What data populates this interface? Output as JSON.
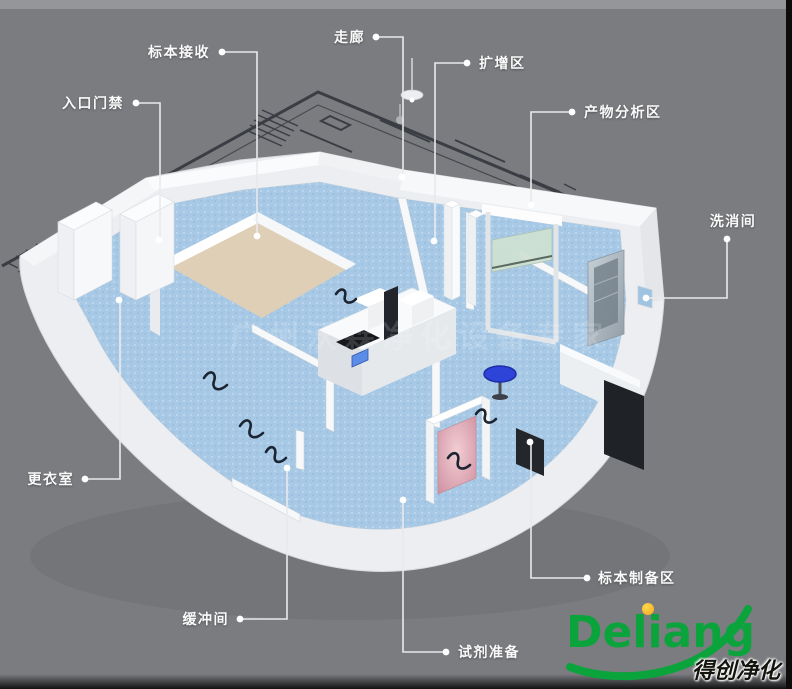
{
  "watermark": "广州沃霖净化设备专家",
  "labels": [
    {
      "id": "specimen-receiving",
      "text": "标本接收",
      "align": "right",
      "tx": 216,
      "ty": 52,
      "line": [
        [
          222,
          52
        ],
        [
          257,
          52
        ],
        [
          257,
          236
        ]
      ],
      "dots": [
        [
          222,
          52
        ],
        [
          257,
          236
        ]
      ]
    },
    {
      "id": "entrance-access",
      "text": "入口门禁",
      "align": "right",
      "tx": 130,
      "ty": 103,
      "line": [
        [
          136,
          103
        ],
        [
          160,
          103
        ],
        [
          160,
          240
        ]
      ],
      "dots": [
        [
          136,
          103
        ],
        [
          159,
          240
        ]
      ]
    },
    {
      "id": "corridor",
      "text": "走廊",
      "align": "right",
      "tx": 371,
      "ty": 37,
      "line": [
        [
          376,
          37
        ],
        [
          403,
          37
        ],
        [
          403,
          177
        ]
      ],
      "dots": [
        [
          376,
          37
        ],
        [
          402,
          177
        ]
      ]
    },
    {
      "id": "amplification-area",
      "text": "扩增区",
      "align": "left",
      "tx": 473,
      "ty": 63,
      "line": [
        [
          467,
          63
        ],
        [
          435,
          63
        ],
        [
          435,
          241
        ]
      ],
      "dots": [
        [
          467,
          63
        ],
        [
          434,
          241
        ]
      ]
    },
    {
      "id": "product-analysis-area",
      "text": "产物分析区",
      "align": "left",
      "tx": 578,
      "ty": 112,
      "line": [
        [
          572,
          112
        ],
        [
          531,
          112
        ],
        [
          531,
          205
        ]
      ],
      "dots": [
        [
          572,
          112
        ],
        [
          531,
          205
        ]
      ]
    },
    {
      "id": "washing-room",
      "text": "洗消间",
      "align": "center",
      "tx": 733,
      "ty": 221,
      "line": [
        [
          727,
          239
        ],
        [
          727,
          298
        ],
        [
          646,
          298
        ]
      ],
      "dots": [
        [
          727,
          239
        ],
        [
          646,
          298
        ]
      ]
    },
    {
      "id": "changing-room",
      "text": "更衣室",
      "align": "right",
      "tx": 80,
      "ty": 479,
      "line": [
        [
          85,
          479
        ],
        [
          120,
          479
        ],
        [
          120,
          300
        ]
      ],
      "dots": [
        [
          85,
          479
        ],
        [
          119,
          300
        ]
      ]
    },
    {
      "id": "buffer-room",
      "text": "缓冲间",
      "align": "right",
      "tx": 235,
      "ty": 619,
      "line": [
        [
          240,
          619
        ],
        [
          287,
          619
        ],
        [
          287,
          468
        ]
      ],
      "dots": [
        [
          240,
          619
        ],
        [
          287,
          468
        ]
      ]
    },
    {
      "id": "reagent-prep",
      "text": "试剂准备",
      "align": "left",
      "tx": 452,
      "ty": 652,
      "line": [
        [
          446,
          652
        ],
        [
          403,
          652
        ],
        [
          403,
          500
        ]
      ],
      "dots": [
        [
          446,
          652
        ],
        [
          403,
          500
        ]
      ]
    },
    {
      "id": "specimen-prep-area",
      "text": "标本制备区",
      "align": "left",
      "tx": 592,
      "ty": 578,
      "line": [
        [
          587,
          578
        ],
        [
          531,
          578
        ],
        [
          531,
          442
        ]
      ],
      "dots": [
        [
          587,
          578
        ],
        [
          530,
          442
        ]
      ]
    }
  ],
  "logo": {
    "brand": "Deliang",
    "tagline": "得创净化"
  },
  "colors": {
    "background": "#7b7c80",
    "floor-blue": "#a7c9e6",
    "floor-beige": "#decfb6",
    "wall-white": "#eceef1",
    "label-white": "#fafafa",
    "leader-line": "#e9eaec",
    "logo-green": "#0ba43c",
    "logo-orange": "#f3a81c",
    "cabinet-pink": "#dfa9b4",
    "stool-blue": "#2e43d8",
    "plan-line": "#34373d"
  }
}
